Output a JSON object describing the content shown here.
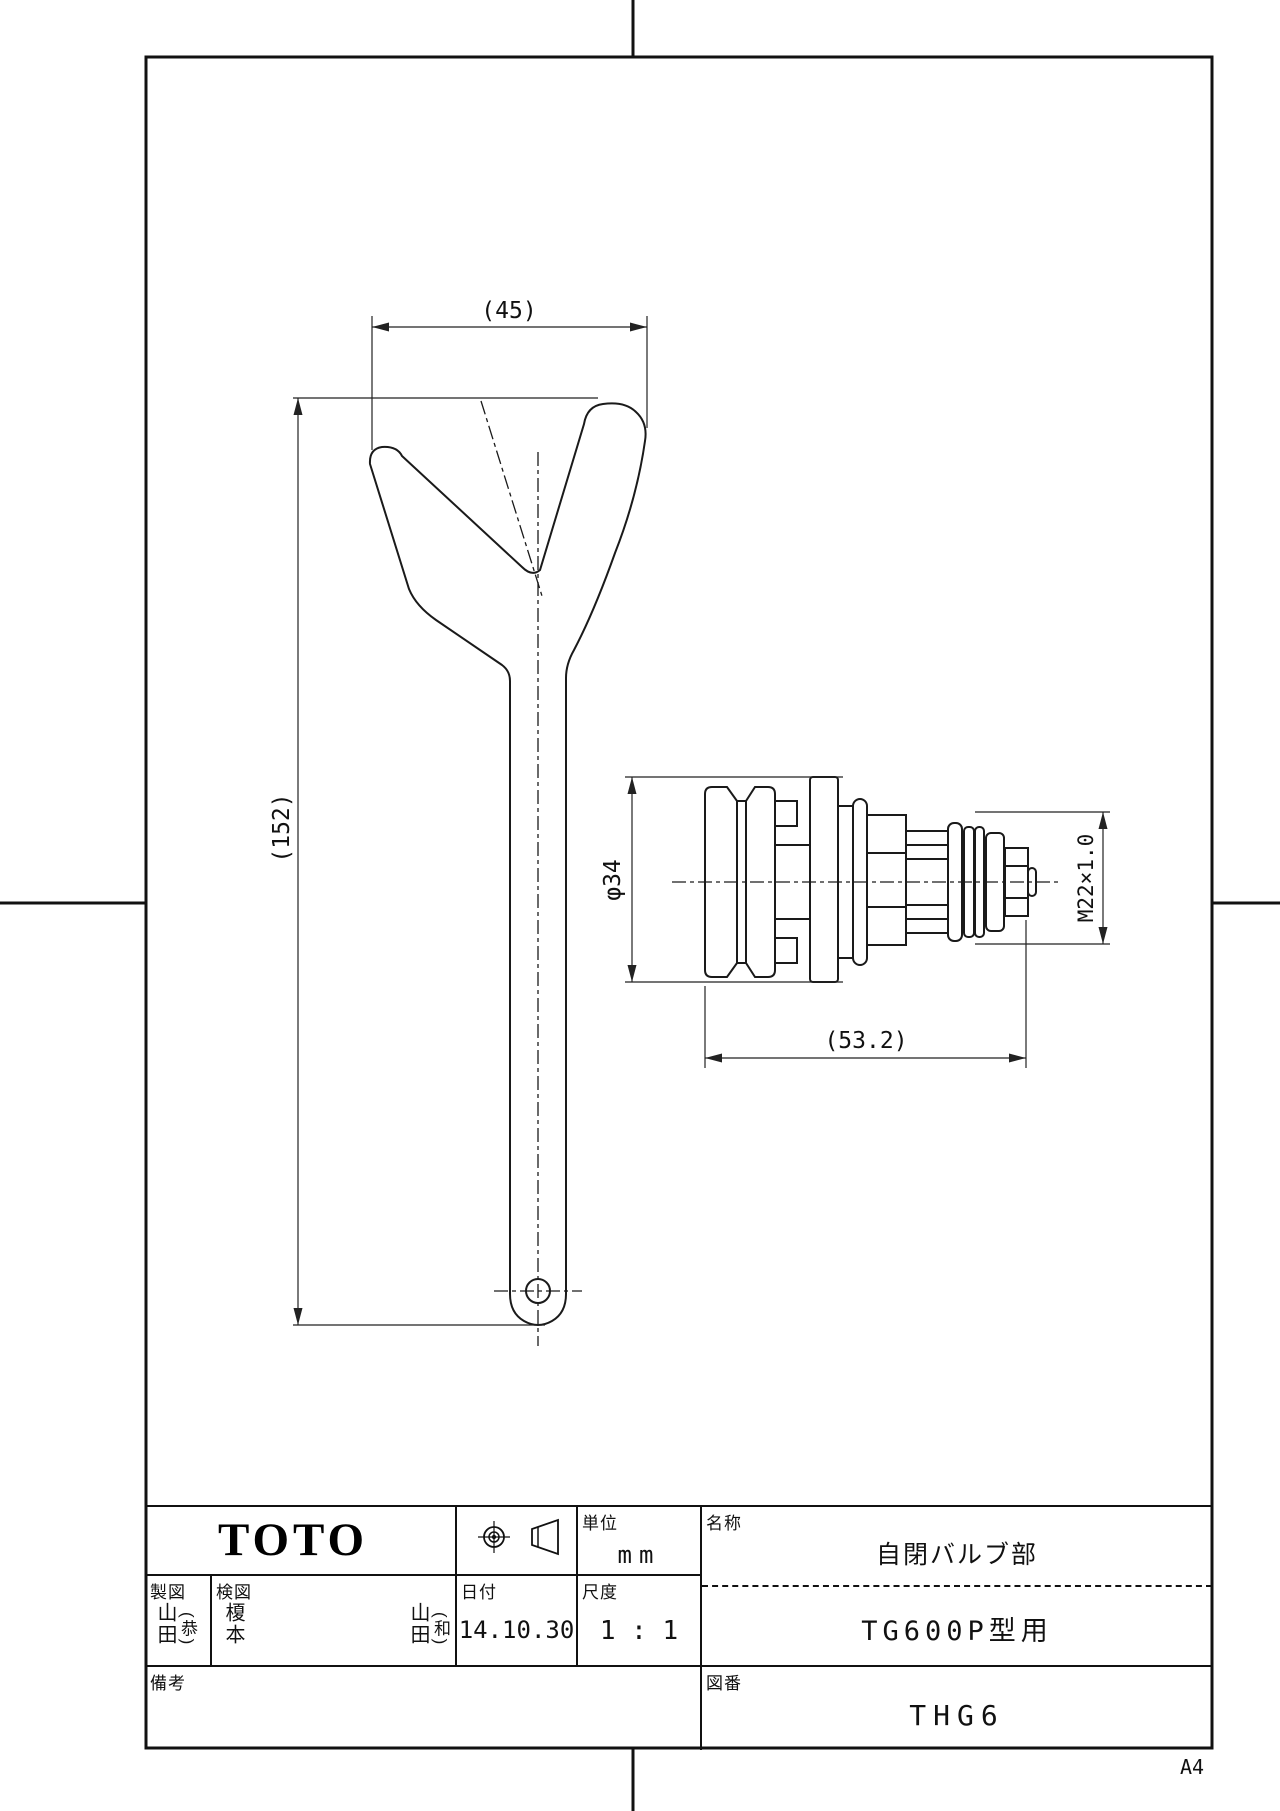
{
  "sheet": {
    "size_label": "A4"
  },
  "dimensions": {
    "fork_width": "(45)",
    "overall_length": "(152)",
    "valve_diameter": "φ34",
    "thread_spec": "M22×1.0",
    "valve_length": "(53.2)"
  },
  "title_block": {
    "company_logo": "TOTO",
    "unit_label": "単位",
    "unit_value": "mm",
    "name_label": "名称",
    "part_name": "自閉バルブ部",
    "model_application": "TG600P型用",
    "drafter_label": "製図",
    "drafter_name": "山田",
    "drafter_suffix": "(恭)",
    "checker_label": "検図",
    "checker_name1": "榎本",
    "checker_name2": "山田",
    "checker_name2_suffix": "(和)",
    "date_label": "日付",
    "date_value": "14.10.30",
    "scale_label": "尺度",
    "scale_value": "1 : 1",
    "remarks_label": "備考",
    "drawing_no_label": "図番",
    "drawing_no": "THG6"
  },
  "icons": {
    "projection_symbol": "first-angle-projection-symbol"
  }
}
